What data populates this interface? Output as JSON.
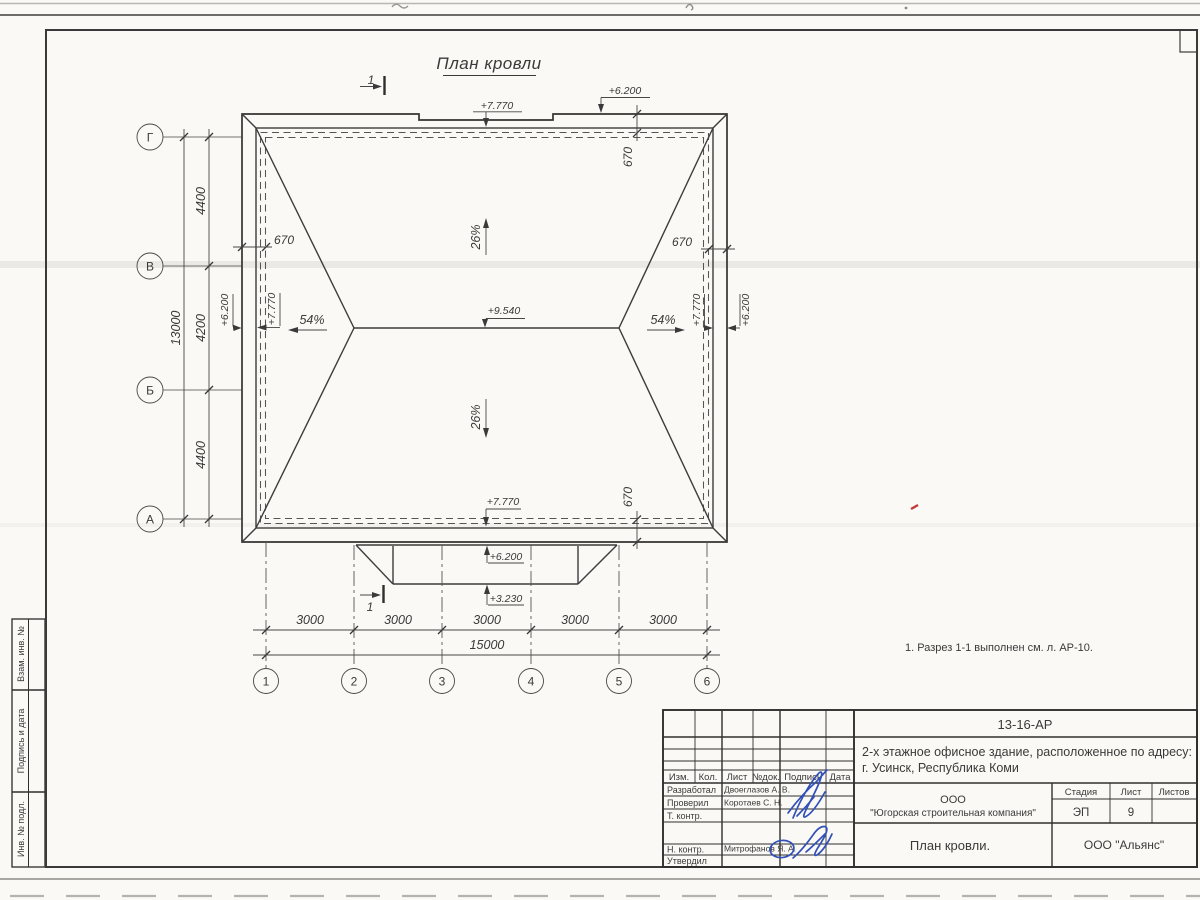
{
  "drawing": {
    "title": "План кровли",
    "note": "1. Разрез 1-1 выполнен см. л. АР-10.",
    "section_label": "1",
    "slope_main": "26%",
    "slope_hip": "54%",
    "elev_ridge": "+9.540",
    "elev_eave": "+7.770",
    "elev_parapet": "+6.200",
    "elev_canopy": "+3.230",
    "overhang": "670",
    "axes_cols": [
      "1",
      "2",
      "3",
      "4",
      "5",
      "6"
    ],
    "axes_rows": [
      "Г",
      "В",
      "Б",
      "А"
    ],
    "dim_col_segments": [
      "3000",
      "3000",
      "3000",
      "3000",
      "3000"
    ],
    "dim_col_total": "15000",
    "dim_row_segments": [
      "4400",
      "4200",
      "4400"
    ],
    "dim_row_total": "13000"
  },
  "stamp": {
    "doc_number": "13-16-АР",
    "project_line1": "2-х этажное офисное здание, расположенное по адресу:",
    "project_line2": "г. Усинск, Республика Коми",
    "header_cols": [
      "Изм.",
      "Кол.",
      "Лист",
      "№док.",
      "Подпись",
      "Дата"
    ],
    "roles": [
      "Разработал",
      "Проверил",
      "Т. контр.",
      "Н. контр.",
      "Утвердил"
    ],
    "names": [
      "Двоеглазов А. В.",
      "Коротаев С. Н.",
      "Митрофанов Я. А."
    ],
    "company_line1": "ООО",
    "company_line2": "\"Югорская строительная компания\"",
    "stage_label": "Стадия",
    "sheet_label": "Лист",
    "sheets_label": "Листов",
    "stage_value": "ЭП",
    "sheet_value": "9",
    "drawing_name": "План кровли.",
    "org_name": "ООО \"Альянс\""
  },
  "side_strip": {
    "cells": [
      "Взам. инв. №",
      "Подпись и дата",
      "Инв. № подл."
    ]
  },
  "colors": {
    "ink": "#3a3a3a",
    "signature_blue": "#3150b8",
    "red_mark": "#c23a3a"
  }
}
